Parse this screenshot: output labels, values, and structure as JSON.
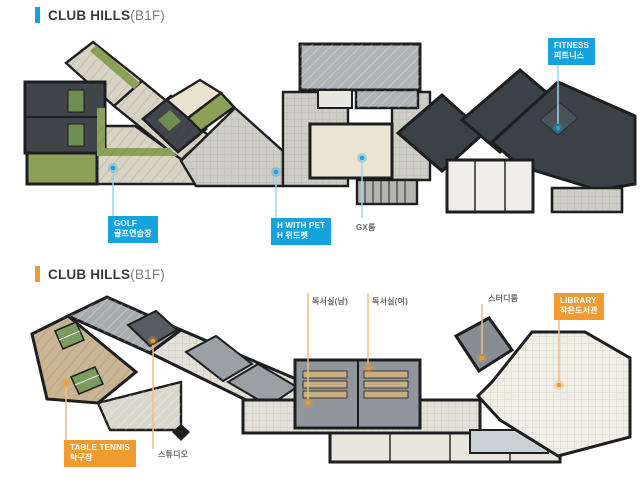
{
  "sections": [
    {
      "id": "top-plan",
      "accent_color": "#15a3e0",
      "title": {
        "main": "CLUB HILLS",
        "suffix": "(B1F)"
      },
      "labels": {
        "fitness": {
          "line1": "FITNESS",
          "line2": "피트니스"
        },
        "golf": {
          "line1": "GOLF",
          "line2": "골프연습장"
        },
        "h_with_pet": {
          "line1": "H WITH PET",
          "line2": "H 위드펫"
        },
        "gx_room": {
          "text": "GX룸"
        }
      }
    },
    {
      "id": "bottom-plan",
      "accent_color": "#f09a32",
      "title": {
        "main": "CLUB HILLS",
        "suffix": "(B1F)"
      },
      "labels": {
        "library": {
          "line1": "LIBRARY",
          "line2": "작은도서관"
        },
        "table_tennis": {
          "line1": "TABLE TENNIS",
          "line2": "탁구장"
        },
        "reading_room_m": {
          "text": "독서실(남)"
        },
        "reading_room_f": {
          "text": "독서실(여)"
        },
        "study_room": {
          "text": "스터디룸"
        },
        "studio": {
          "text": "스튜디오"
        }
      }
    }
  ]
}
